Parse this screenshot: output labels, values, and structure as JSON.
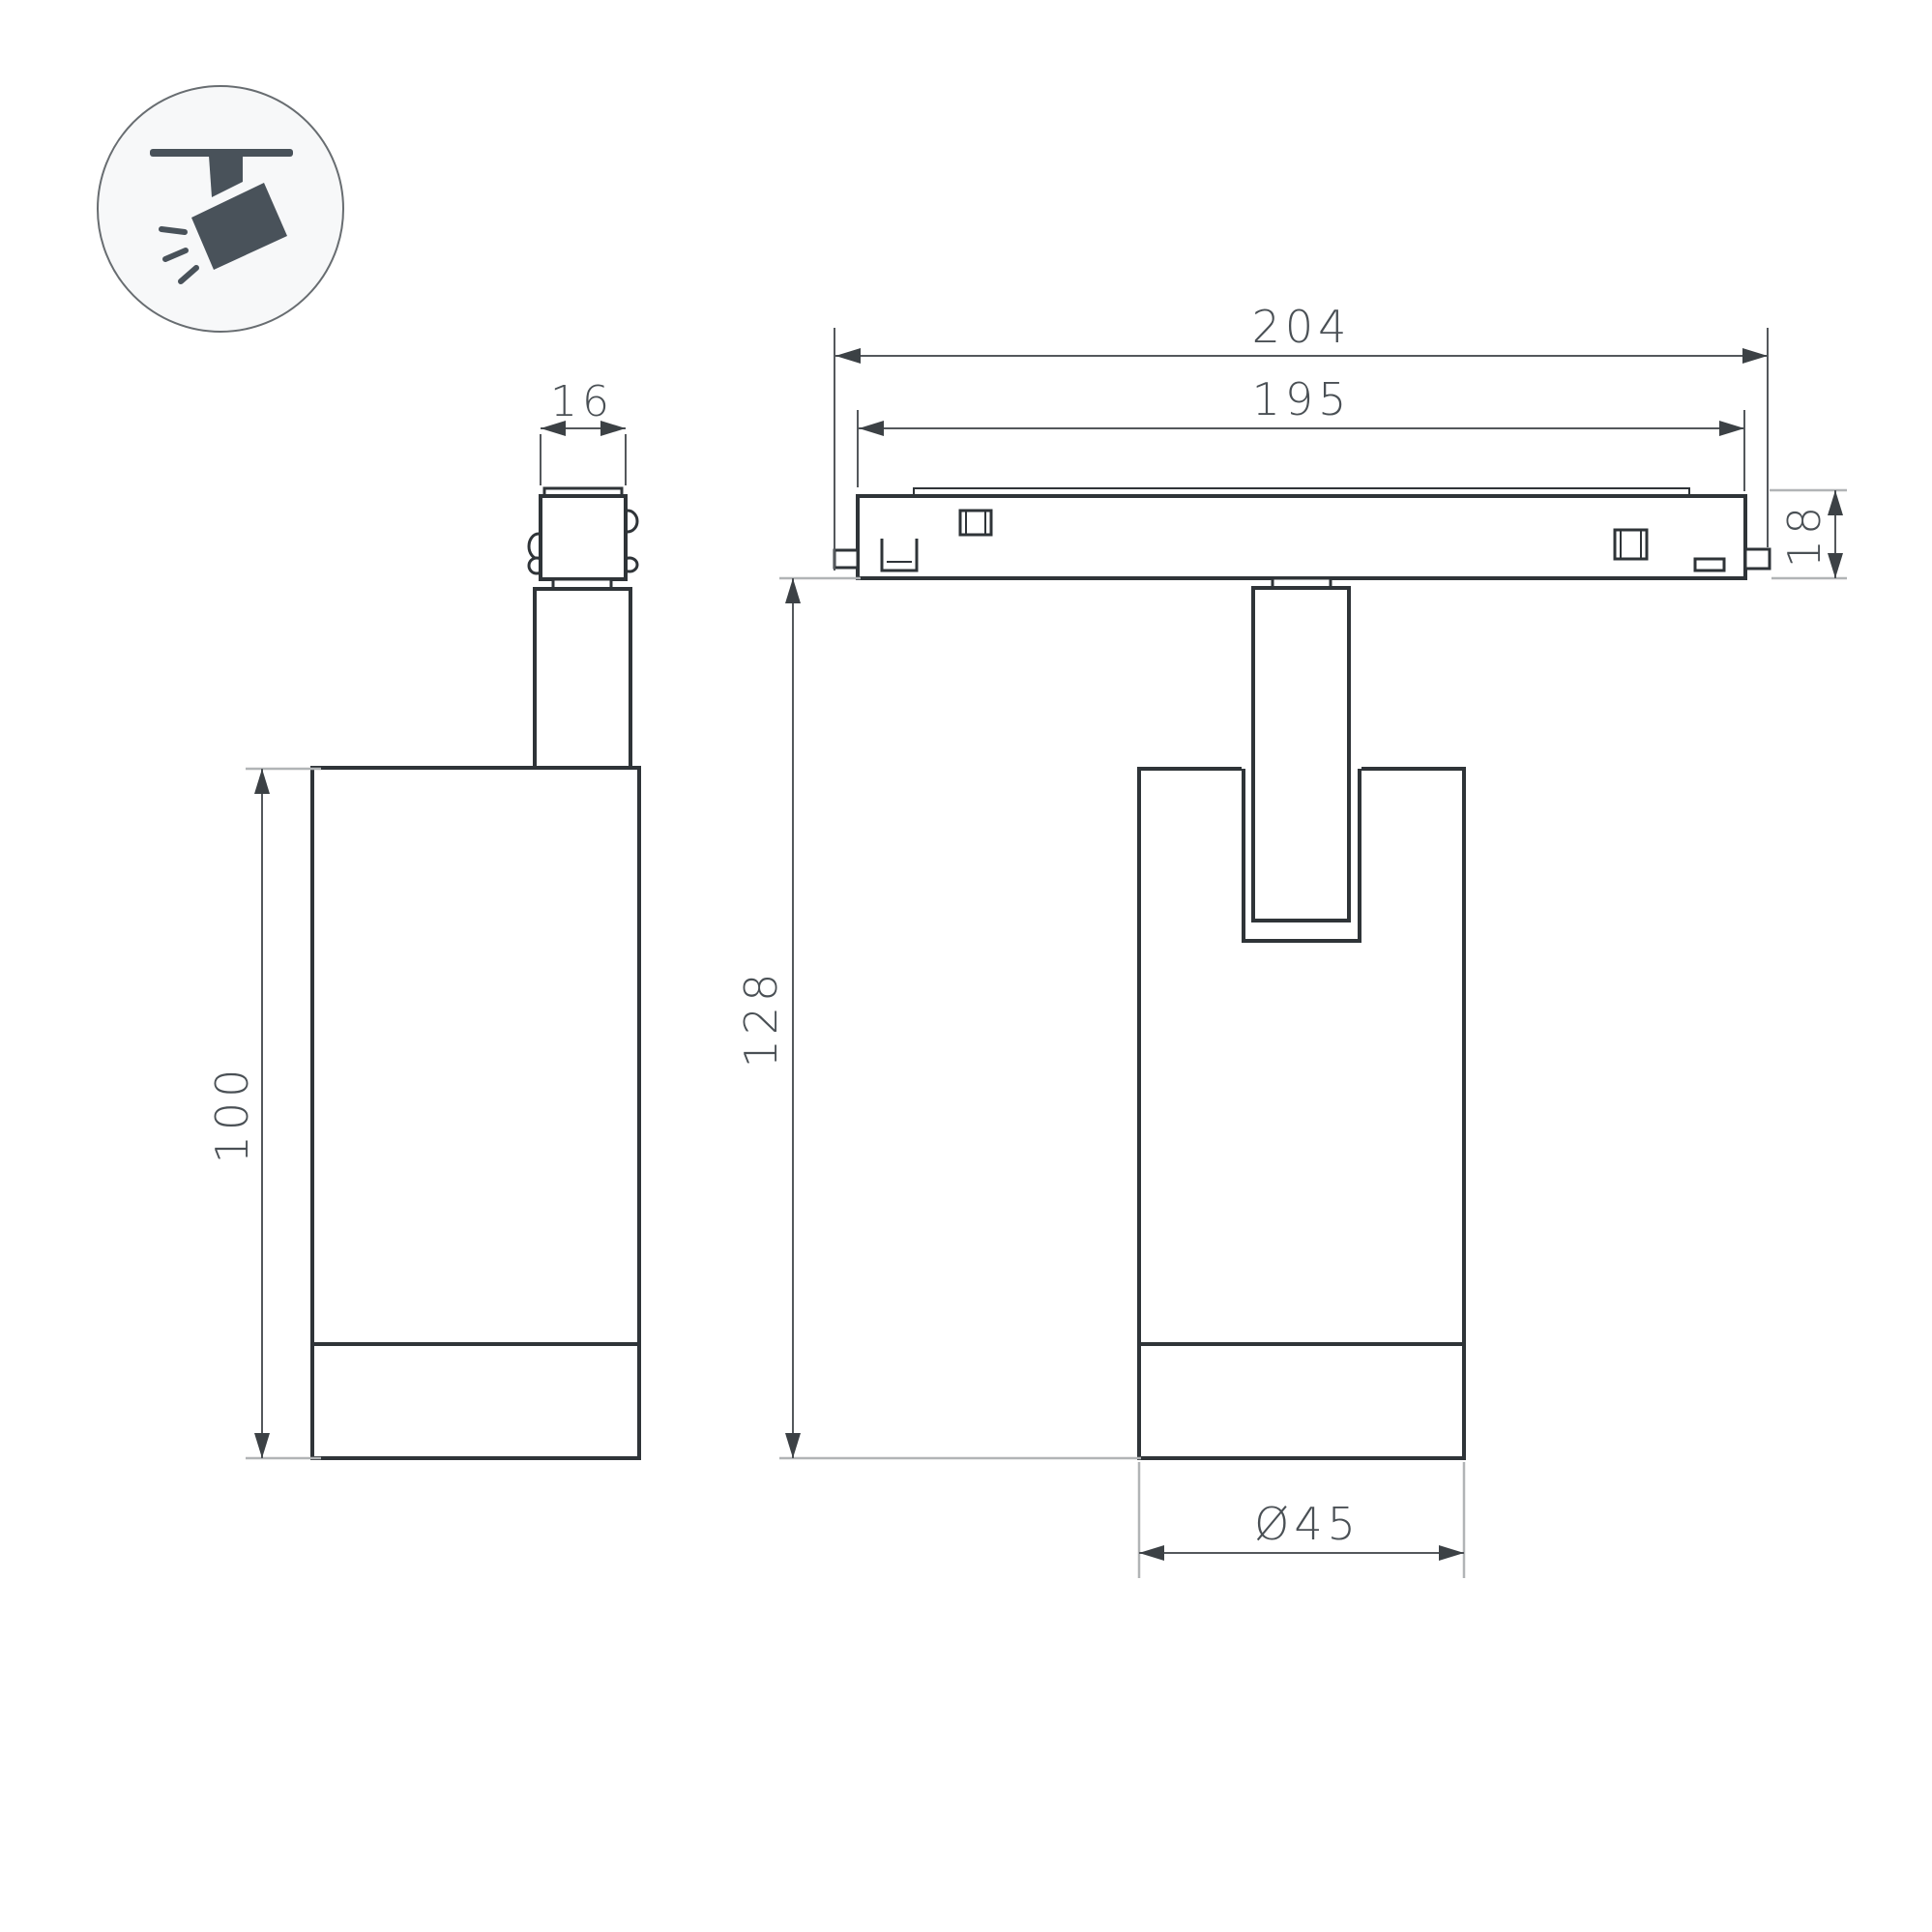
{
  "icon_legend": {
    "name": "track-spotlight-icon"
  },
  "side_view": {
    "connector_width": "16",
    "body_height": "100"
  },
  "front_view": {
    "track_overall_length": "204",
    "rail_length": "195",
    "track_height": "18",
    "overall_height": "128",
    "body_diameter": "Ø45"
  },
  "colors": {
    "outline": "#2f3438",
    "dim": "#54585c",
    "light": "#b1b4b6",
    "arrow": "#3c4145",
    "text": "#4a5055",
    "icon": "#49525a",
    "circle": "#686d71",
    "bg": "#ffffff"
  }
}
